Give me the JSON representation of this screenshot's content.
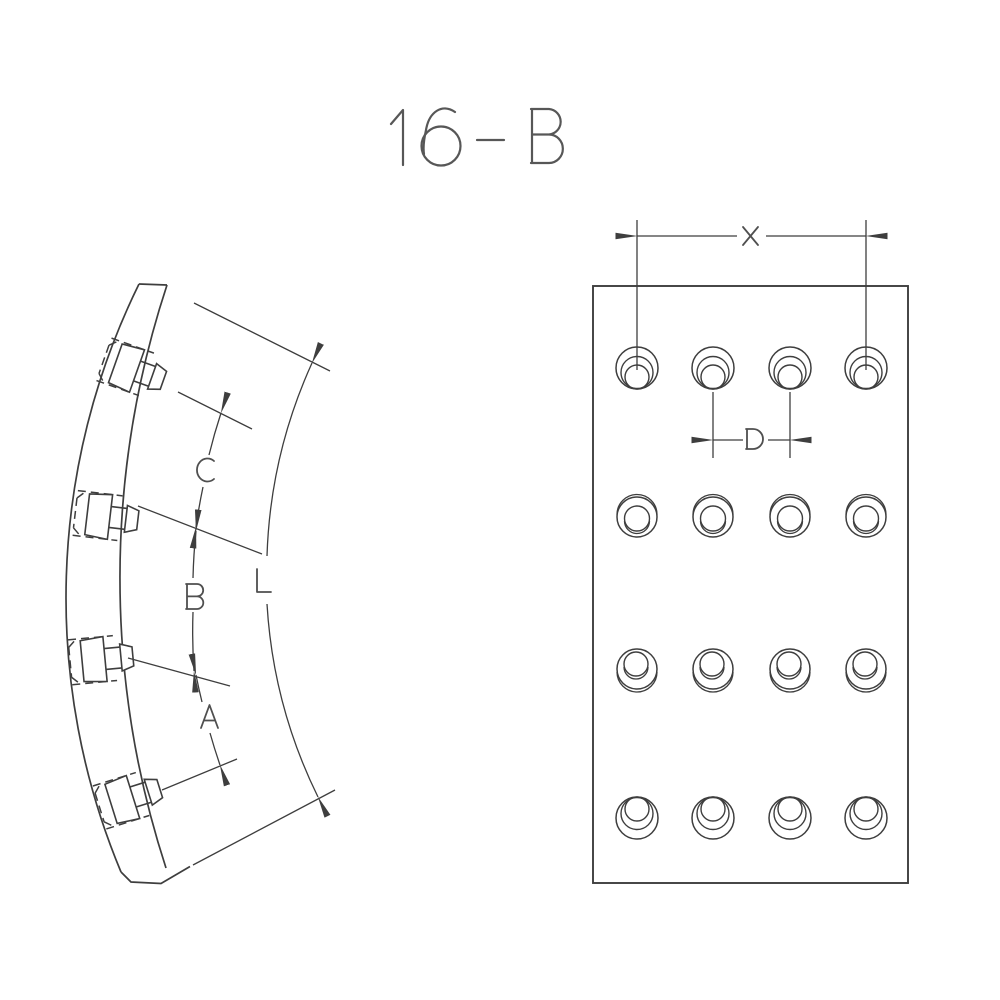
{
  "title": "16-B",
  "colors": {
    "line": "#3e3e3e",
    "label": "#4f4f4f",
    "background": "#ffffff"
  },
  "labels": {
    "title": "16-B",
    "arc_c": "C",
    "arc_b": "B",
    "arc_a": "A",
    "overall_length": "L",
    "span_x": "X",
    "pitch_d": "D"
  },
  "side_view": {
    "description": "curved brake lining segment, edge view with rivets",
    "rivet_count": 4,
    "dimension_labels": [
      "C",
      "B",
      "A",
      "L"
    ]
  },
  "face_view": {
    "description": "brake lining face view with rivet holes",
    "hole_rows": 4,
    "hole_columns": 4,
    "hole_count": 16,
    "dimension_labels": [
      "X",
      "D"
    ]
  }
}
